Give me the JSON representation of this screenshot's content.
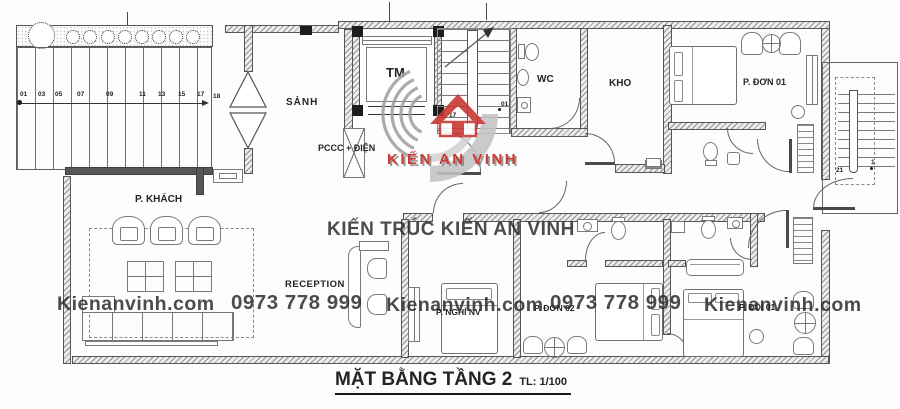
{
  "title": {
    "text": "MẶT BẰNG TẦNG 2",
    "scale": "TL: 1/100"
  },
  "rooms": {
    "hall": "SẢNH",
    "elevator": "TM",
    "fire_electrical": "PCCC + ĐIỆN",
    "wc": "WC",
    "storage": "KHO",
    "single_room_01": "P. ĐƠN 01",
    "living_room": "P. KHÁCH",
    "reception": "RECEPTION",
    "staff_rest_room": "P. NGHỈ NV",
    "single_room_02": "P. ĐƠN 02",
    "double_room": "P. ĐÔI 01"
  },
  "stairs": {
    "left_steps": [
      "01",
      "03",
      "05",
      "07",
      "09",
      "11",
      "13",
      "15",
      "17",
      "18"
    ],
    "main_bottom": "17",
    "main_top": "01",
    "right_bottom": "21",
    "right_top": "1"
  },
  "watermark": {
    "brand_line": "KIẾN TRÚC KIẾN AN VINH",
    "logo_text": "KIẾN AN VINH",
    "website": "Kienanvinh.com",
    "phone": "0973 778 999"
  },
  "colors": {
    "logo_red": "#c8342e",
    "watermark_gray": "#2e2e2e",
    "wall_line": "#555555"
  }
}
